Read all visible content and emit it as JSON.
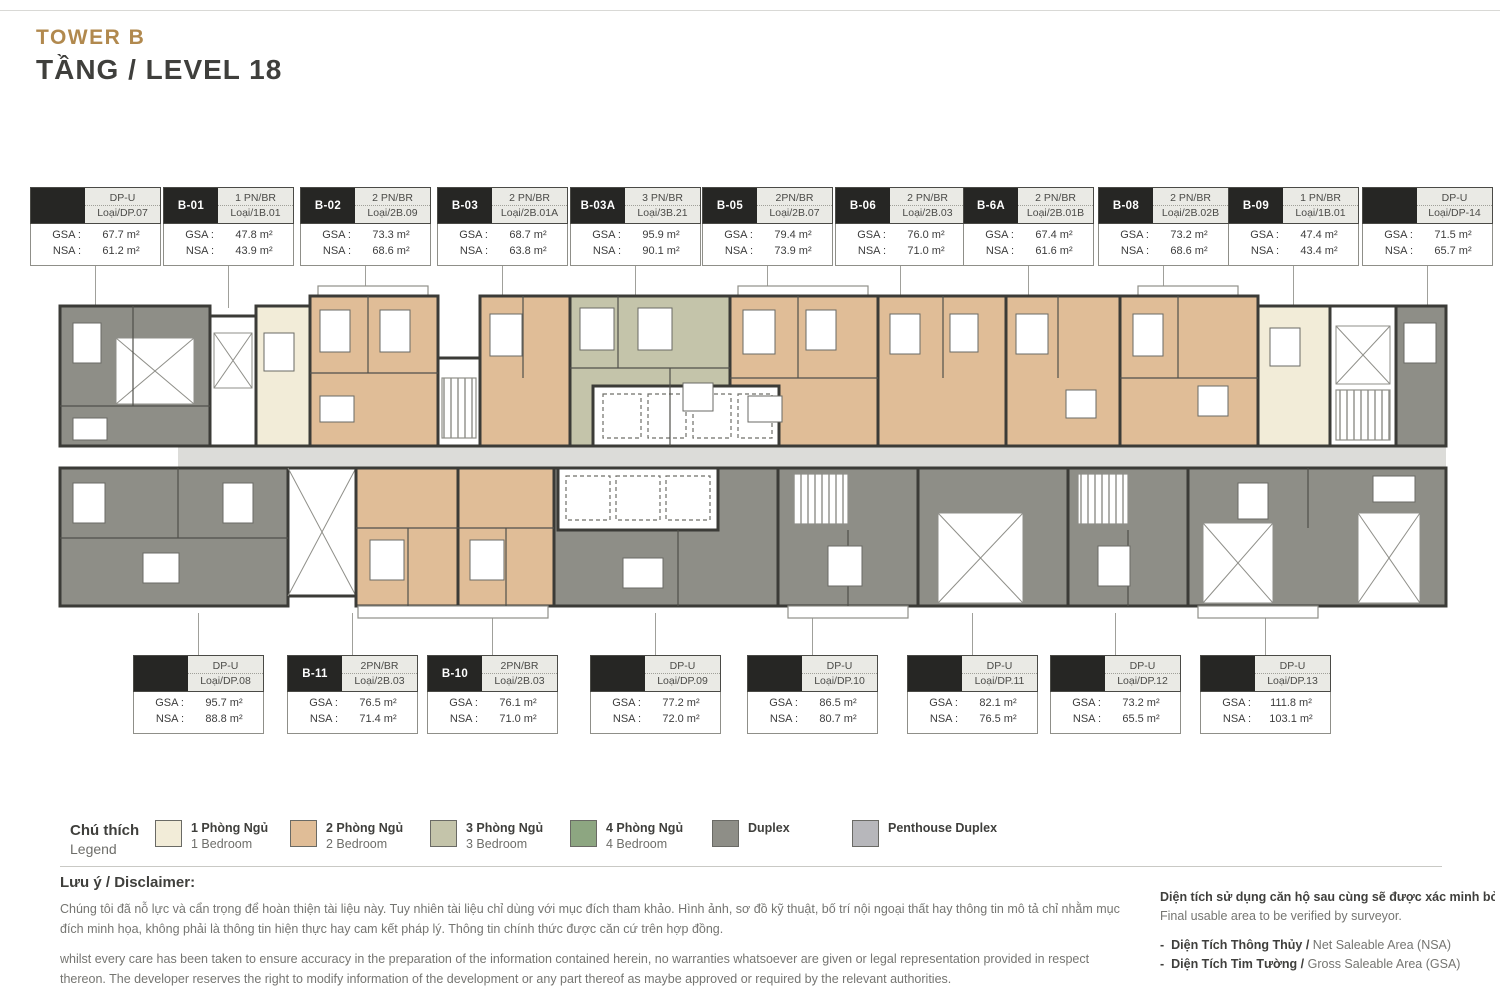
{
  "header": {
    "tower": "TOWER B",
    "level": "TẦNG / LEVEL 18"
  },
  "labels": {
    "gsa": "GSA :",
    "nsa": "NSA :"
  },
  "unit_labels": {
    "top": [
      {
        "code": "",
        "type": "DP-U",
        "layout": "Loại/DP.07",
        "gsa": "67.7 m²",
        "nsa": "61.2 m²",
        "x": 30
      },
      {
        "code": "B-01",
        "type": "1 PN/BR",
        "layout": "Loại/1B.01",
        "gsa": "47.8 m²",
        "nsa": "43.9 m²",
        "x": 163
      },
      {
        "code": "B-02",
        "type": "2 PN/BR",
        "layout": "Loại/2B.09",
        "gsa": "73.3 m²",
        "nsa": "68.6 m²",
        "x": 300
      },
      {
        "code": "B-03",
        "type": "2 PN/BR",
        "layout": "Loại/2B.01A",
        "gsa": "68.7 m²",
        "nsa": "63.8 m²",
        "x": 437
      },
      {
        "code": "B-03A",
        "type": "3 PN/BR",
        "layout": "Loại/3B.21",
        "gsa": "95.9 m²",
        "nsa": "90.1 m²",
        "x": 570
      },
      {
        "code": "B-05",
        "type": "2PN/BR",
        "layout": "Loại/2B.07",
        "gsa": "79.4 m²",
        "nsa": "73.9 m²",
        "x": 702
      },
      {
        "code": "B-06",
        "type": "2 PN/BR",
        "layout": "Loại/2B.03",
        "gsa": "76.0 m²",
        "nsa": "71.0 m²",
        "x": 835
      },
      {
        "code": "B-6A",
        "type": "2 PN/BR",
        "layout": "Loại/2B.01B",
        "gsa": "67.4 m²",
        "nsa": "61.6 m²",
        "x": 963
      },
      {
        "code": "B-08",
        "type": "2 PN/BR",
        "layout": "Loại/2B.02B",
        "gsa": "73.2 m²",
        "nsa": "68.6 m²",
        "x": 1098
      },
      {
        "code": "B-09",
        "type": "1 PN/BR",
        "layout": "Loại/1B.01",
        "gsa": "47.4 m²",
        "nsa": "43.4 m²",
        "x": 1228
      },
      {
        "code": "",
        "type": "DP-U",
        "layout": "Loại/DP-14",
        "gsa": "71.5 m²",
        "nsa": "65.7 m²",
        "x": 1362
      }
    ],
    "bottom": [
      {
        "code": "",
        "type": "DP-U",
        "layout": "Loại/DP.08",
        "gsa": "95.7 m²",
        "nsa": "88.8 m²",
        "x": 133
      },
      {
        "code": "B-11",
        "type": "2PN/BR",
        "layout": "Loại/2B.03",
        "gsa": "76.5 m²",
        "nsa": "71.4 m²",
        "x": 287
      },
      {
        "code": "B-10",
        "type": "2PN/BR",
        "layout": "Loại/2B.03",
        "gsa": "76.1 m²",
        "nsa": "71.0 m²",
        "x": 427
      },
      {
        "code": "",
        "type": "DP-U",
        "layout": "Loại/DP.09",
        "gsa": "77.2 m²",
        "nsa": "72.0 m²",
        "x": 590
      },
      {
        "code": "",
        "type": "DP-U",
        "layout": "Loại/DP.10",
        "gsa": "86.5 m²",
        "nsa": "80.7 m²",
        "x": 747
      },
      {
        "code": "",
        "type": "DP-U",
        "layout": "Loại/DP.11",
        "gsa": "82.1 m²",
        "nsa": "76.5 m²",
        "x": 907
      },
      {
        "code": "",
        "type": "DP-U",
        "layout": "Loại/DP.12",
        "gsa": "73.2 m²",
        "nsa": "65.5 m²",
        "x": 1050
      },
      {
        "code": "",
        "type": "DP-U",
        "layout": "Loại/DP.13",
        "gsa": "111.8 m²",
        "nsa": "103.1 m²",
        "x": 1200
      }
    ]
  },
  "legend": {
    "title_vi": "Chú thích",
    "title_en": "Legend",
    "items": [
      {
        "vi": "1 Phòng Ngủ",
        "en": "1 Bedroom",
        "color": "#f2ecd8",
        "x": 155
      },
      {
        "vi": "2 Phòng Ngủ",
        "en": "2 Bedroom",
        "color": "#e0bd97",
        "x": 290
      },
      {
        "vi": "3 Phòng Ngủ",
        "en": "3 Bedroom",
        "color": "#c4c4aa",
        "x": 430
      },
      {
        "vi": "4 Phòng Ngủ",
        "en": "4 Bedroom",
        "color": "#8da681",
        "x": 570
      },
      {
        "vi": "Duplex",
        "en": "",
        "color": "#8e8e87",
        "x": 712
      },
      {
        "vi": "Penthouse Duplex",
        "en": "",
        "color": "#b7b7bb",
        "x": 852
      }
    ]
  },
  "disclaimer": {
    "heading": "Lưu ý / Disclaimer:",
    "para_vi": "Chúng tôi đã nỗ lực và cẩn trọng để hoàn thiện tài liệu này. Tuy nhiên tài liệu chỉ dùng với mục đích tham khảo. Hình ảnh, sơ đồ kỹ thuật, bố trí nội ngoại thất hay thông tin mô tả chỉ nhằm mục đích minh họa, không phải là thông tin hiện thực hay cam kết pháp lý. Thông tin chính thức được căn cứ trên hợp đồng.",
    "para_en": "whilst every care has been taken to ensure accuracy in the preparation of the information contained herein, no warranties whatsoever are given or legal representation provided in respect thereon. The developer reserves the right to modify information of the development or any part thereof as maybe approved or required by the relevant authorities."
  },
  "notes": {
    "line1_vi": "Diện tích sử dụng căn hộ sau cùng sẽ được xác minh bởi đơn vị đo",
    "line1_en": "Final usable area to be verified by surveyor.",
    "bullets": [
      {
        "dash": "-",
        "vi": "Diện Tích Thông Thủy /",
        "en": "Net Saleable Area (NSA)"
      },
      {
        "dash": "-",
        "vi": "Diện Tích Tim Tường /",
        "en": "Gross Saleable Area (GSA)"
      }
    ]
  },
  "colors": {
    "accent_gold": "#b1894e",
    "wall": "#3b3b37",
    "corridor": "#dcdcd9",
    "label_black": "#262624"
  }
}
